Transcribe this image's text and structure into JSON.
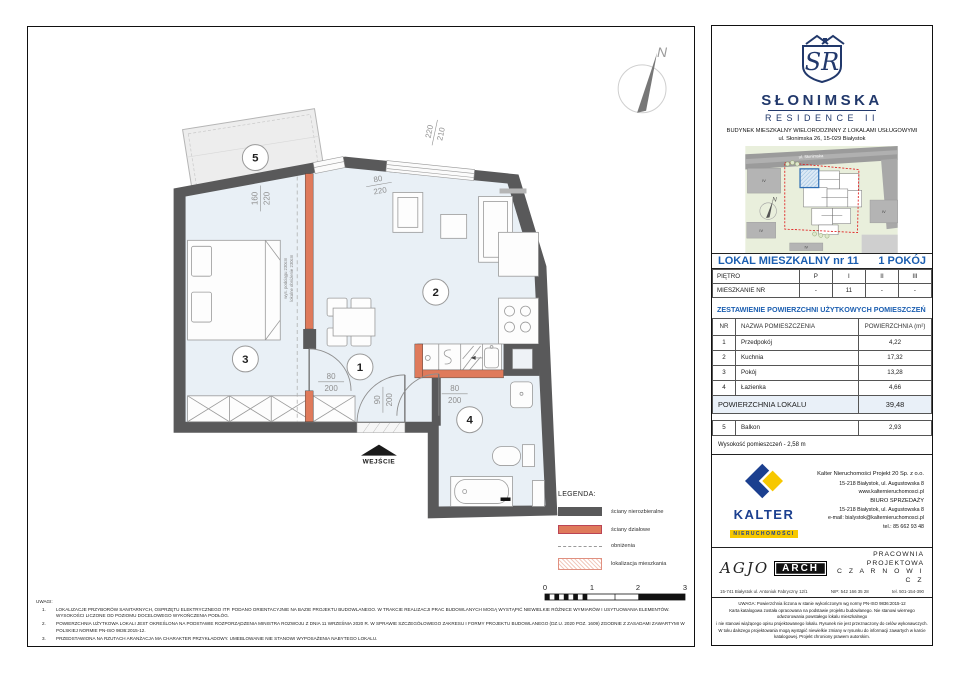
{
  "brand": {
    "monogram": "SR",
    "name": "SŁONIMSKA",
    "sub": "RESIDENCE II",
    "line1": "BUDYNEK MIESZKALNY WIELORODZINNY Z LOKALAMI USŁUGOWYMI",
    "line2": "ul. Słonimska 26, 15-029 Białystok",
    "navy": "#21386b"
  },
  "sitemap": {
    "street": "ul. Słonimska",
    "north": "N",
    "blocks": [
      "IV",
      "IV",
      "IV",
      "IV"
    ],
    "boundary_color": "#e01818",
    "highlight_color": "#2e6db4"
  },
  "plan": {
    "north": "N",
    "entrance_label": "WEJŚCIE",
    "room_numbers": [
      "1",
      "2",
      "3",
      "4",
      "5"
    ],
    "dims": {
      "balcony": {
        "num": "160",
        "den": "220"
      },
      "balcony_door": {
        "num": "80",
        "den": "220"
      },
      "window": {
        "num": "220",
        "den": "210"
      },
      "room3_door": {
        "num": "80",
        "den": "200"
      },
      "entry_door": {
        "num": "90",
        "den": "200"
      },
      "bath_door": {
        "num": "80",
        "den": "200"
      }
    },
    "annotation": {
      "line1": "wys. podciągu 230cm",
      "line2": "lokalne obniżenie 230cm"
    },
    "colors": {
      "floor": "#e9f0f6",
      "wall": "#59595a",
      "partition": "#df7a5b",
      "balcony": "#ededed"
    }
  },
  "legend": {
    "title": "LEGENDA:",
    "items": [
      {
        "label": "ściany nierozbieralne"
      },
      {
        "label": "ściany działowe"
      },
      {
        "label": "obniżenia"
      },
      {
        "label": "lokalizacja mieszkania"
      }
    ]
  },
  "scalebar": {
    "labels": [
      "0",
      "1",
      "2",
      "3"
    ]
  },
  "notes": {
    "title": "UWAGI:",
    "items": [
      {
        "no": "1.",
        "text": "LOKALIZACJE PRZYBORÓW SANITARNYCH, OSPRZĘTU ELEKTRYCZNEGO ITP. PODANO ORIENTACYJNIE NA BAZIE PROJEKTU BUDOWLANEGO. W TRAKCIE REALIZACJI PRAC BUDOWLANYCH MOGĄ WYSTĄPIĆ NIEWIELKIE RÓŻNICE WYMIARÓW I USYTUOWANIA ELEMENTÓW. WYSOKOŚCI LICZONE OD POZIOMU DOCELOWEGO WYKOŃCZENIA PODŁÓG."
      },
      {
        "no": "2.",
        "text": "POWIERZCHNIA UŻYTKOWA LOKALI JEST OKREŚLONA NA PODSTAWIE ROZPORZĄDZENIA MINISTRA ROZWOJU Z DNIA 11 WRZEŚNIA 2020 R. W SPRAWIE SZCZEGÓŁOWEGO ZAKRESU I FORMY PROJEKTU BUDOWLANEGO (DZ.U. 2020 POZ. 1609) ZGODNIE Z ZASADAMI ZAWARTYMI W POLSKIEJ NORMIE PN-ISO 9836:2015-12."
      },
      {
        "no": "3.",
        "text": "PRZEDSTAWIONA NA RZUTACH ARANŻACJA MA CHARAKTER PRZYKŁADOWY. UMEBLOWANIE NIE STANOWI WYPOSAŻENIA NABYTEGO LOKALU."
      }
    ]
  },
  "unit": {
    "title_left": "LOKAL MIESZKALNY  nr 11",
    "title_right": "1 POKÓJ",
    "floor_table": {
      "row1": {
        "label": "PIĘTRO",
        "values": [
          "P",
          "I",
          "II",
          "III"
        ]
      },
      "row2": {
        "label": "MIESZKANIE NR",
        "values": [
          "-",
          "11",
          "-",
          "-"
        ]
      }
    },
    "section_title": "ZESTAWIENIE POWIERZCHNI UŻYTKOWYCH POMIESZCZEŃ",
    "columns": {
      "nr": "NR",
      "name": "NAZWA POMIESZCZENIA",
      "area": "POWIERZCHNIA (m²)"
    },
    "rooms": [
      {
        "nr": "1",
        "name": "Przedpokój",
        "area": "4,22"
      },
      {
        "nr": "2",
        "name": "Kuchnia",
        "area": "17,32"
      },
      {
        "nr": "3",
        "name": "Pokój",
        "area": "13,28"
      },
      {
        "nr": "4",
        "name": "Łazienka",
        "area": "4,66"
      }
    ],
    "total_label": "POWIERZCHNIA LOKALU",
    "total_value": "39,48",
    "extra": {
      "nr": "5",
      "name": "Balkon",
      "area": "2,93"
    },
    "height_note": "Wysokość pomieszczeń - 2,58 m"
  },
  "developer": {
    "logo_text": "KALTER",
    "logo_sub": "NIERUCHOMOŚCI",
    "company": "Kalter Nieruchomości Projekt 20  Sp. z o.o.",
    "address1": "15-218 Białystok, ul. Augustowska 8",
    "website": "www.kalternieruchomosci.pl",
    "office": "BIURO SPRZEDAŻY",
    "address2": "15-218 Białystok, ul. Augustowska 8",
    "email": "e-mail: bialystok@kalternieruchomosci.pl",
    "phone": "tel.: 85 662 93 48",
    "brand_blue": "#1b3f8f",
    "brand_yellow": "#f7c800"
  },
  "architect": {
    "logo_script": "AGJO",
    "logo_box": "ARCH",
    "line1": "PRACOWNIA PROJEKTOWA",
    "line2": "C Z A R N O W I C Z",
    "address": "15-741 Białystok   ul. Antoniuk Fabryczny 12/1",
    "nip": "NIP:  542 166 35 28",
    "tel": "tel. 501-154-390"
  },
  "fineprint": [
    "UWAGA:  Powierzchnia liczona w stanie wykończonym wg normy PN-ISO 9836:2015-12",
    "Karta katalogowa została opracowana na podstawie projektu budowlanego. Nie stanowi wiernego odwzorowania powstałego lokalu mieszkalnego",
    "i nie stanowi wiążącego opisu projektowanego lokalu. Rysunek nie jest przeznaczony do celów wykonawczych.",
    "W toku dalszego projektowania mogą wystąpić niewielkie zmiany w rysunku do informacji zawartych w karcie katalogowej. Projekt chroniony prawem autorskim."
  ]
}
